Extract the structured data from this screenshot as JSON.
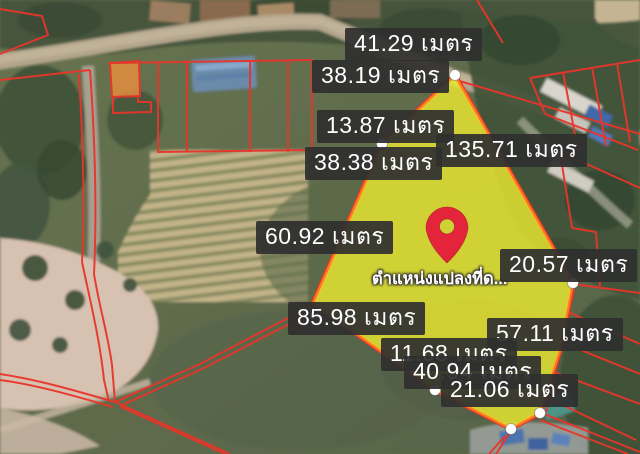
{
  "map": {
    "kind": "satellite-cadastre-view",
    "colors": {
      "parcel_line": "#e8352b",
      "plot_fill": "#edeb30",
      "plot_border": "#ff7a1f",
      "plot_outline": "#e8352b",
      "label_bg": "#2f2f2f",
      "label_text": "#ffffff",
      "pin": "#e3243b",
      "vertex_dot": "#ffffff"
    },
    "pin": {
      "icon": "map-pin-icon",
      "caption": "ตำแหน่งแปลงที่ด...",
      "x": 447,
      "y": 263
    },
    "plot": {
      "vertices": [
        [
          455,
          75
        ],
        [
          573,
          283
        ],
        [
          561,
          348
        ],
        [
          540,
          413
        ],
        [
          511,
          429
        ],
        [
          435,
          390
        ],
        [
          313,
          303
        ],
        [
          382,
          144
        ]
      ],
      "vertex_dots": [
        [
          455,
          75
        ],
        [
          382,
          144
        ],
        [
          573,
          283
        ],
        [
          435,
          390
        ],
        [
          511,
          429
        ],
        [
          540,
          413
        ]
      ]
    },
    "measurements": [
      {
        "value": "41.29",
        "unit": "เมตร",
        "x": 345,
        "y": 28
      },
      {
        "value": "38.19",
        "unit": "เมตร",
        "x": 312,
        "y": 60
      },
      {
        "value": "13.87",
        "unit": "เมตร",
        "x": 317,
        "y": 110
      },
      {
        "value": "38.38",
        "unit": "เมตร",
        "x": 305,
        "y": 147
      },
      {
        "value": "135.71",
        "unit": "เมตร",
        "x": 436,
        "y": 134
      },
      {
        "value": "60.92",
        "unit": "เมตร",
        "x": 256,
        "y": 221
      },
      {
        "value": "20.57",
        "unit": "เมตร",
        "x": 500,
        "y": 249
      },
      {
        "value": "85.98",
        "unit": "เมตร",
        "x": 288,
        "y": 302
      },
      {
        "value": "57.11",
        "unit": "เมตร",
        "x": 487,
        "y": 318
      },
      {
        "value": "11.68",
        "unit": "เมตร",
        "x": 381,
        "y": 338
      },
      {
        "value": "40.94",
        "unit": "เมตร",
        "x": 404,
        "y": 356
      },
      {
        "value": "21.06",
        "unit": "เมตร",
        "x": 441,
        "y": 374
      }
    ]
  }
}
